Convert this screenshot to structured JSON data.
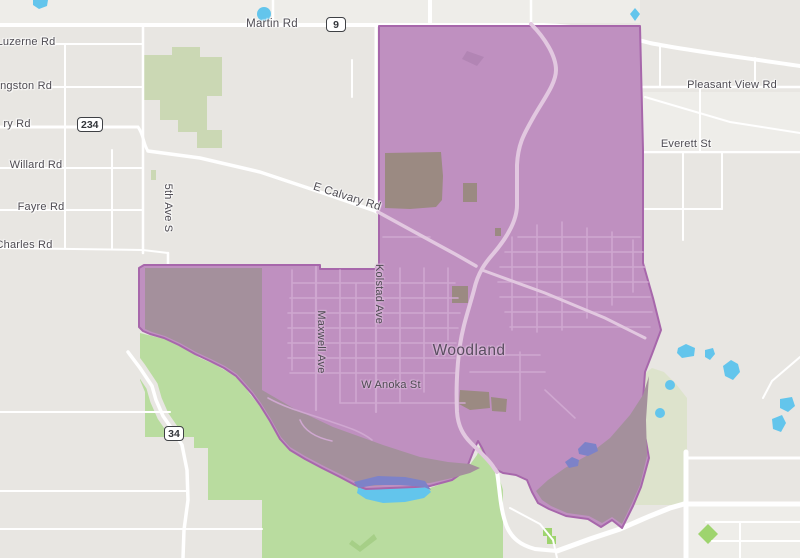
{
  "map": {
    "place_label": "Woodland",
    "labels": [
      {
        "id": "martin-rd",
        "text": "Martin Rd",
        "x": 272,
        "y": 24,
        "rot": 0,
        "halo": "light"
      },
      {
        "id": "luzerne-rd",
        "text": "Luzerne Rd",
        "x": 26,
        "y": 42,
        "rot": 0,
        "halo": "light"
      },
      {
        "id": "kingston-rd",
        "text": "Kingston Rd",
        "x": 21,
        "y": 86,
        "rot": 0,
        "halo": "light"
      },
      {
        "id": "ry-rd",
        "text": "ry Rd",
        "x": 17,
        "y": 124,
        "rot": 0,
        "halo": "light"
      },
      {
        "id": "willard-rd",
        "text": "Willard Rd",
        "x": 36,
        "y": 165,
        "rot": 0,
        "halo": "light"
      },
      {
        "id": "fayre-rd",
        "text": "Fayre Rd",
        "x": 41,
        "y": 207,
        "rot": 0,
        "halo": "light"
      },
      {
        "id": "charles-rd",
        "text": "Charles Rd",
        "x": 24,
        "y": 245,
        "rot": 0,
        "halo": "light"
      },
      {
        "id": "fifth-ave-s",
        "text": "5th Ave S",
        "x": 168,
        "y": 208,
        "rot": 90,
        "halo": "light"
      },
      {
        "id": "e-calvary-rd",
        "text": "E Calvary Rd",
        "x": 347,
        "y": 197,
        "rot": 17.5,
        "halo": "light"
      },
      {
        "id": "kolstad-ave",
        "text": "Kolstad Ave",
        "x": 379,
        "y": 294,
        "rot": 90,
        "halo": "purple"
      },
      {
        "id": "maxwell-ave",
        "text": "Maxwell Ave",
        "x": 321,
        "y": 342,
        "rot": 90,
        "halo": "purple"
      },
      {
        "id": "w-anoka-st",
        "text": "W Anoka St",
        "x": 391,
        "y": 385,
        "rot": 0,
        "halo": "purple"
      },
      {
        "id": "elk-st",
        "text": "Elk St",
        "x": 732,
        "y": 85,
        "rot": 0,
        "halo": "light"
      },
      {
        "id": "pleasant-view-rd",
        "text": "Pleasant View Rd",
        "x": 686,
        "y": 144,
        "rot": 0,
        "halo": "light"
      },
      {
        "id": "everett-st",
        "text": "Everett St",
        "x": 753,
        "y": 445,
        "rot": 0,
        "halo": "light"
      }
    ],
    "shields": [
      {
        "id": "shield-9",
        "text": "9",
        "x": 326,
        "y": 17
      },
      {
        "id": "shield-234",
        "text": "234",
        "x": 77,
        "y": 117
      },
      {
        "id": "shield-34",
        "text": "34",
        "x": 164,
        "y": 426
      }
    ],
    "colors": {
      "land": "#e8e6e2",
      "land_light": "#eeede9",
      "overlay": "#bf90c0",
      "overlay_dark": "#a4909c",
      "overlay_outline": "#a767ab",
      "landuse_dark": "#9b8a82",
      "building_purple": "#b285b4",
      "green_muted": "#cbd8b4",
      "green": "#b9dc9f",
      "green_pale": "#dde3cc",
      "green_bright": "#9ed46e",
      "green_dark": "#a6cf87",
      "water": "#63c5ec",
      "water_overlay": "#7d82c8",
      "road": "#ffffff",
      "road_tint": "#e2c8e0",
      "road_grid": "#cfa7d0",
      "label": "#4e4b52",
      "place_label": "#5a4d60",
      "shield_border": "#3f4145",
      "shield_text": "#33363b"
    }
  }
}
